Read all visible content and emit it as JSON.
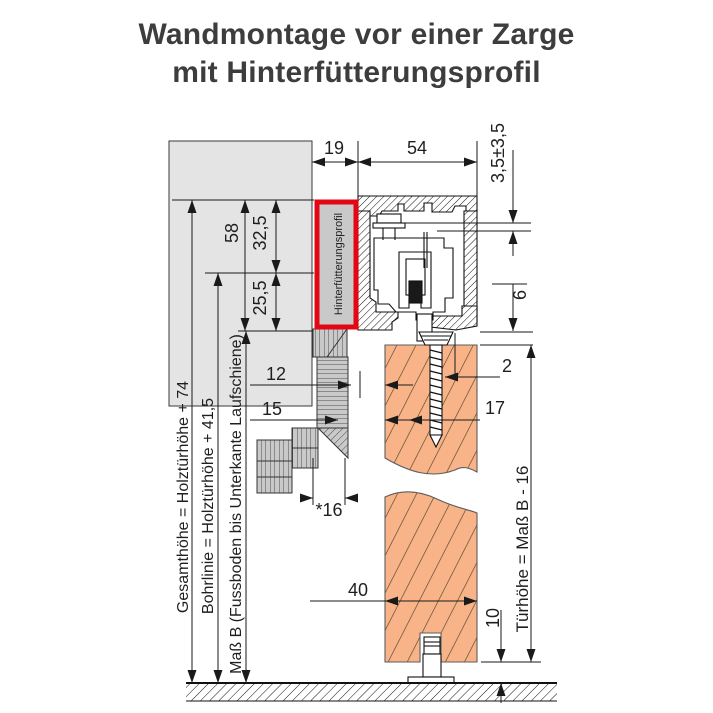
{
  "title": {
    "line1": "Wandmontage vor einer Zarge",
    "line2": "mit Hinterfütterungsprofil"
  },
  "labels": {
    "hinterfuetterungsprofil": "Hinterfütterungsprofil",
    "gesamthoehe": "Gesamthöhe = Holztürhöhe + 74",
    "bohrlinie": "Bohrlinie = Holztürhöhe + 41,5",
    "mass_b": "Maß B (Fussboden bis Unterkante Laufschiene)",
    "tuerhoehe": "Türhöhe = Maß B - 16"
  },
  "dimensions": {
    "top_left": "19",
    "top_right": "54",
    "adjust": "3,5±3,5",
    "gap_track_door": "6",
    "d58": "58",
    "d32_5": "32,5",
    "d25_5": "25,5",
    "d12": "12",
    "d15": "15",
    "d16": "*16",
    "d2": "2",
    "d17": "17",
    "d40": "40",
    "d10": "10"
  },
  "colors": {
    "highlight_red": "#e30613",
    "door_fill": "#f8b488",
    "wall_fill": "#e4e4e4",
    "frame_gray": "#c9c9c9",
    "line": "#1a1a1a",
    "title_text": "#3d3d3d"
  }
}
